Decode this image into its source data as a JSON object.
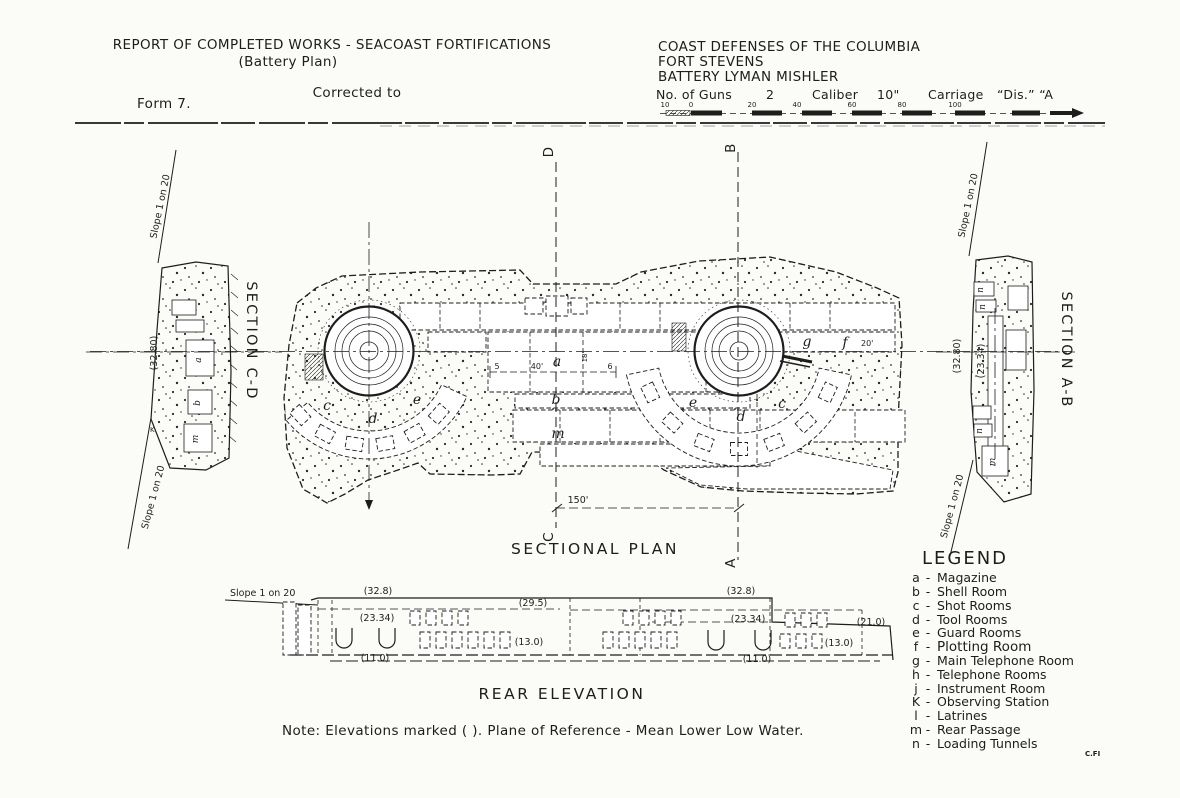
{
  "colors": {
    "ink": "#1d1d1d",
    "paper": "#fbfbf8"
  },
  "header": {
    "report_title": "REPORT OF COMPLETED WORKS - SEACOAST FORTIFICATIONS",
    "battery_plan": "(Battery Plan)",
    "corrected_to": "Corrected to",
    "form_no": "Form 7.",
    "defense": "COAST DEFENSES OF THE COLUMBIA",
    "fort": "FORT STEVENS",
    "battery": "BATTERY LYMAN MISHLER",
    "guns_label": "No. of Guns",
    "guns_value": "2",
    "caliber_label": "Caliber",
    "caliber_value": "10\"",
    "carriage_label": "Carriage",
    "carriage_value": "“Dis.” “A",
    "scale_ticks": [
      "10",
      "0",
      "20",
      "40",
      "60",
      "80",
      "100"
    ]
  },
  "plan": {
    "title": "SECTIONAL PLAN",
    "marker_d": "D",
    "marker_b": "B",
    "marker_c": "C",
    "marker_a": "A",
    "dim_150": "150'",
    "dim_40": "40'",
    "dim_5": "5",
    "dim_6": "6",
    "dim_18": "18'",
    "dim_20": "20'",
    "letters": {
      "a": "a",
      "b": "b",
      "m": "m",
      "c_left": "c",
      "d_left": "d",
      "e_left": "e",
      "e_right": "e",
      "d_right": "d",
      "c_right": "c",
      "g": "g",
      "f": "f"
    }
  },
  "section_cd": {
    "title": "SECTION C-D",
    "slope_top": "Slope 1 on 20",
    "slope_bottom": "Slope 1 on 20",
    "elev": "(32.80)",
    "k": "K",
    "room_a": "a",
    "room_b": "b",
    "room_m": "m"
  },
  "section_ab": {
    "title": "SECTION A-B",
    "slope_top": "Slope 1 on 20",
    "slope_bottom": "Slope 1 on 20",
    "elev_1": "(32.80)",
    "elev_2": "(23.34)",
    "room_n1": "n",
    "room_n2": "n",
    "room_n3": "n",
    "room_m": "m"
  },
  "rear": {
    "title": "REAR ELEVATION",
    "slope": "Slope 1 on 20",
    "e32_left": "(32.8)",
    "e32_right": "(32.8)",
    "e295": "(29.5)",
    "e2334_left": "(23.34)",
    "e2334_right": "(23.34)",
    "e21": "(21.0)",
    "e13_left": "(13.0)",
    "e13_right": "(13.0)",
    "e11_left": "(11.0)",
    "e11_right": "(11.0)"
  },
  "legend": {
    "title": "LEGEND",
    "dash": "-",
    "items": [
      {
        "key": "a",
        "label": "Magazine"
      },
      {
        "key": "b",
        "label": "Shell Room"
      },
      {
        "key": "c",
        "label": "Shot Rooms"
      },
      {
        "key": "d",
        "label": "Tool Rooms"
      },
      {
        "key": "e",
        "label": "Guard Rooms"
      },
      {
        "key": "f",
        "label": "Plotting Room"
      },
      {
        "key": "g",
        "label": "Main Telephone Room"
      },
      {
        "key": "h",
        "label": "Telephone Rooms"
      },
      {
        "key": "j",
        "label": "Instrument Room"
      },
      {
        "key": "K",
        "label": "Observing Station"
      },
      {
        "key": "l",
        "label": "Latrines"
      },
      {
        "key": "m",
        "label": "Rear Passage"
      },
      {
        "key": "n",
        "label": "Loading Tunnels"
      }
    ]
  },
  "note": "Note: Elevations marked ( ). Plane of Reference - Mean Lower Low Water.",
  "credit": "C.FI"
}
